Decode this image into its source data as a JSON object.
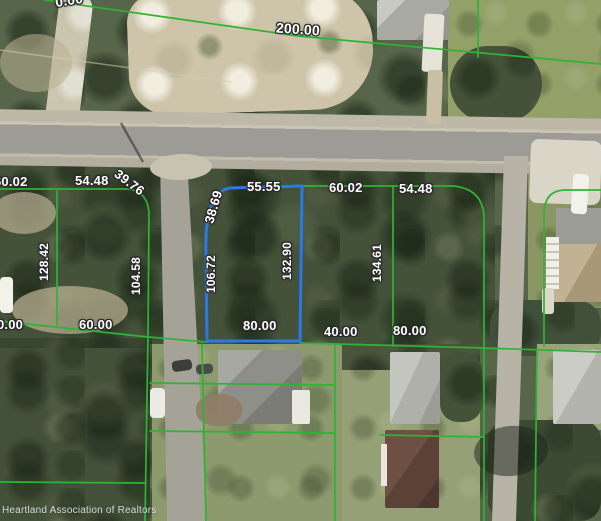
{
  "map": {
    "watermark": "Heartland Association of Realtors",
    "colors": {
      "parcel_line": "#2eb433",
      "highlight_parcel": "#2d78e8",
      "label_text": "#ffffff",
      "label_halo": "#2a2a2a"
    },
    "labels": {
      "top_edge_partial": "0.00",
      "survey_line": "200.00",
      "frontage": [
        "60.02",
        "54.48",
        "39.76",
        "38.69",
        "55.55",
        "60.02",
        "54.48"
      ],
      "depth": [
        "128.42",
        "104.58",
        "106.72",
        "132.90",
        "134.61"
      ],
      "rear": [
        "0.00",
        "60.00",
        "80.00",
        "40.00",
        "80.00"
      ]
    }
  }
}
